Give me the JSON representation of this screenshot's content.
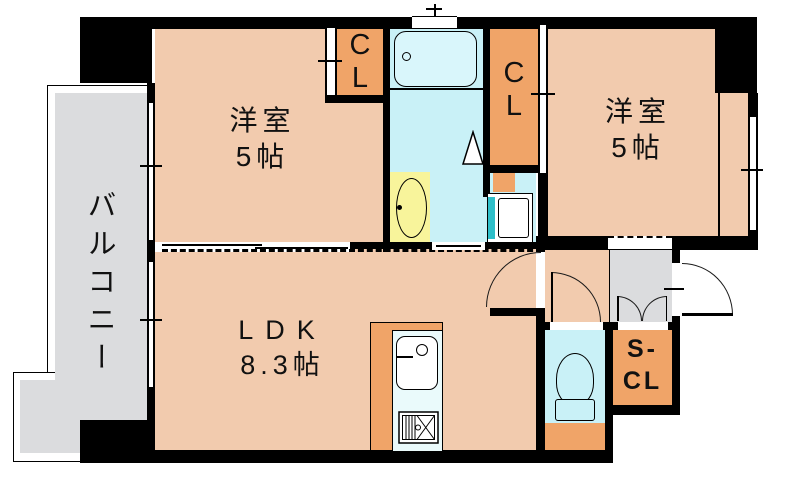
{
  "rooms": {
    "bedroom1": {
      "name": "洋室",
      "size": "5帖"
    },
    "bedroom2": {
      "name": "洋室",
      "size": "5帖"
    },
    "ldk": {
      "name": "LDK",
      "size": "8.3帖"
    },
    "balcony": {
      "name": "バルコニー"
    },
    "closet1": {
      "line1": "C",
      "line2": "L"
    },
    "closet2": {
      "line1": "C",
      "line2": "L"
    },
    "shoe_closet": {
      "line1": "S-",
      "line2": "CL"
    }
  },
  "fixtures": {
    "bathtub": "bathtub",
    "vanity_basin": "vanity-basin",
    "washing_machine": "washing-machine-pan",
    "toilet": "toilet",
    "kitchen_sink": "kitchen-sink",
    "gas_stove": "gas-stove"
  },
  "colors": {
    "wall": "#000000",
    "room_floor": "#F2CBAE",
    "closet": "#F0A468",
    "wet_area": "#C9F1F7",
    "balcony": "#DBDCDE",
    "vanity": "#F8F49B",
    "kitchen_inner": "#EAFAFB",
    "washer_accent": "#2FBFC9",
    "background": "#FFFFFF"
  }
}
